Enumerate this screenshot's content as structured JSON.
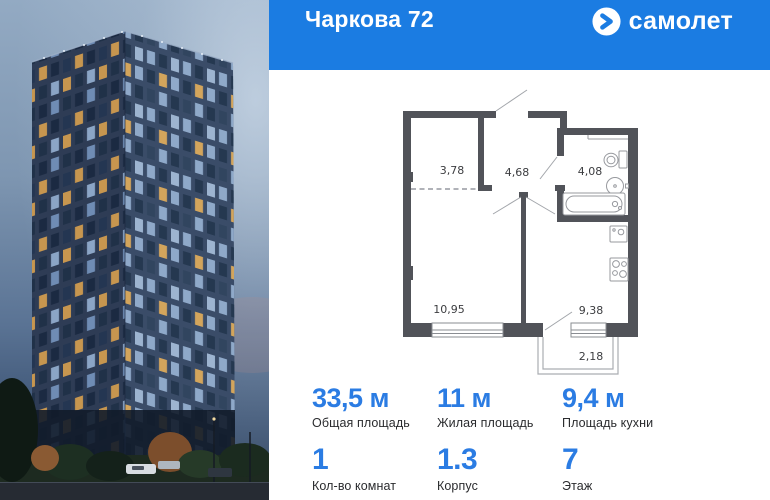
{
  "header": {
    "title": "Чаркова 72",
    "brand": "самолет",
    "brand_icon": "samolet-arrow-icon",
    "bg_color": "#1b7ce2"
  },
  "colors": {
    "accent_blue": "#2b7ce3",
    "plan_wall_gray": "#515359"
  },
  "floorplan": {
    "areas": {
      "closet": "3,78",
      "hall": "4,68",
      "bath": "4,08",
      "living": "10,95",
      "kitchen": "9,38",
      "balcony": "2,18"
    }
  },
  "stats": [
    {
      "value": "33,5 м",
      "label": "Общая площадь"
    },
    {
      "value": "11 м",
      "label": "Жилая площадь"
    },
    {
      "value": "9,4 м",
      "label": "Площадь кухни"
    },
    {
      "value": "1",
      "label": "Кол-во комнат"
    },
    {
      "value": "1.3",
      "label": "Корпус"
    },
    {
      "value": "7",
      "label": "Этаж"
    }
  ]
}
